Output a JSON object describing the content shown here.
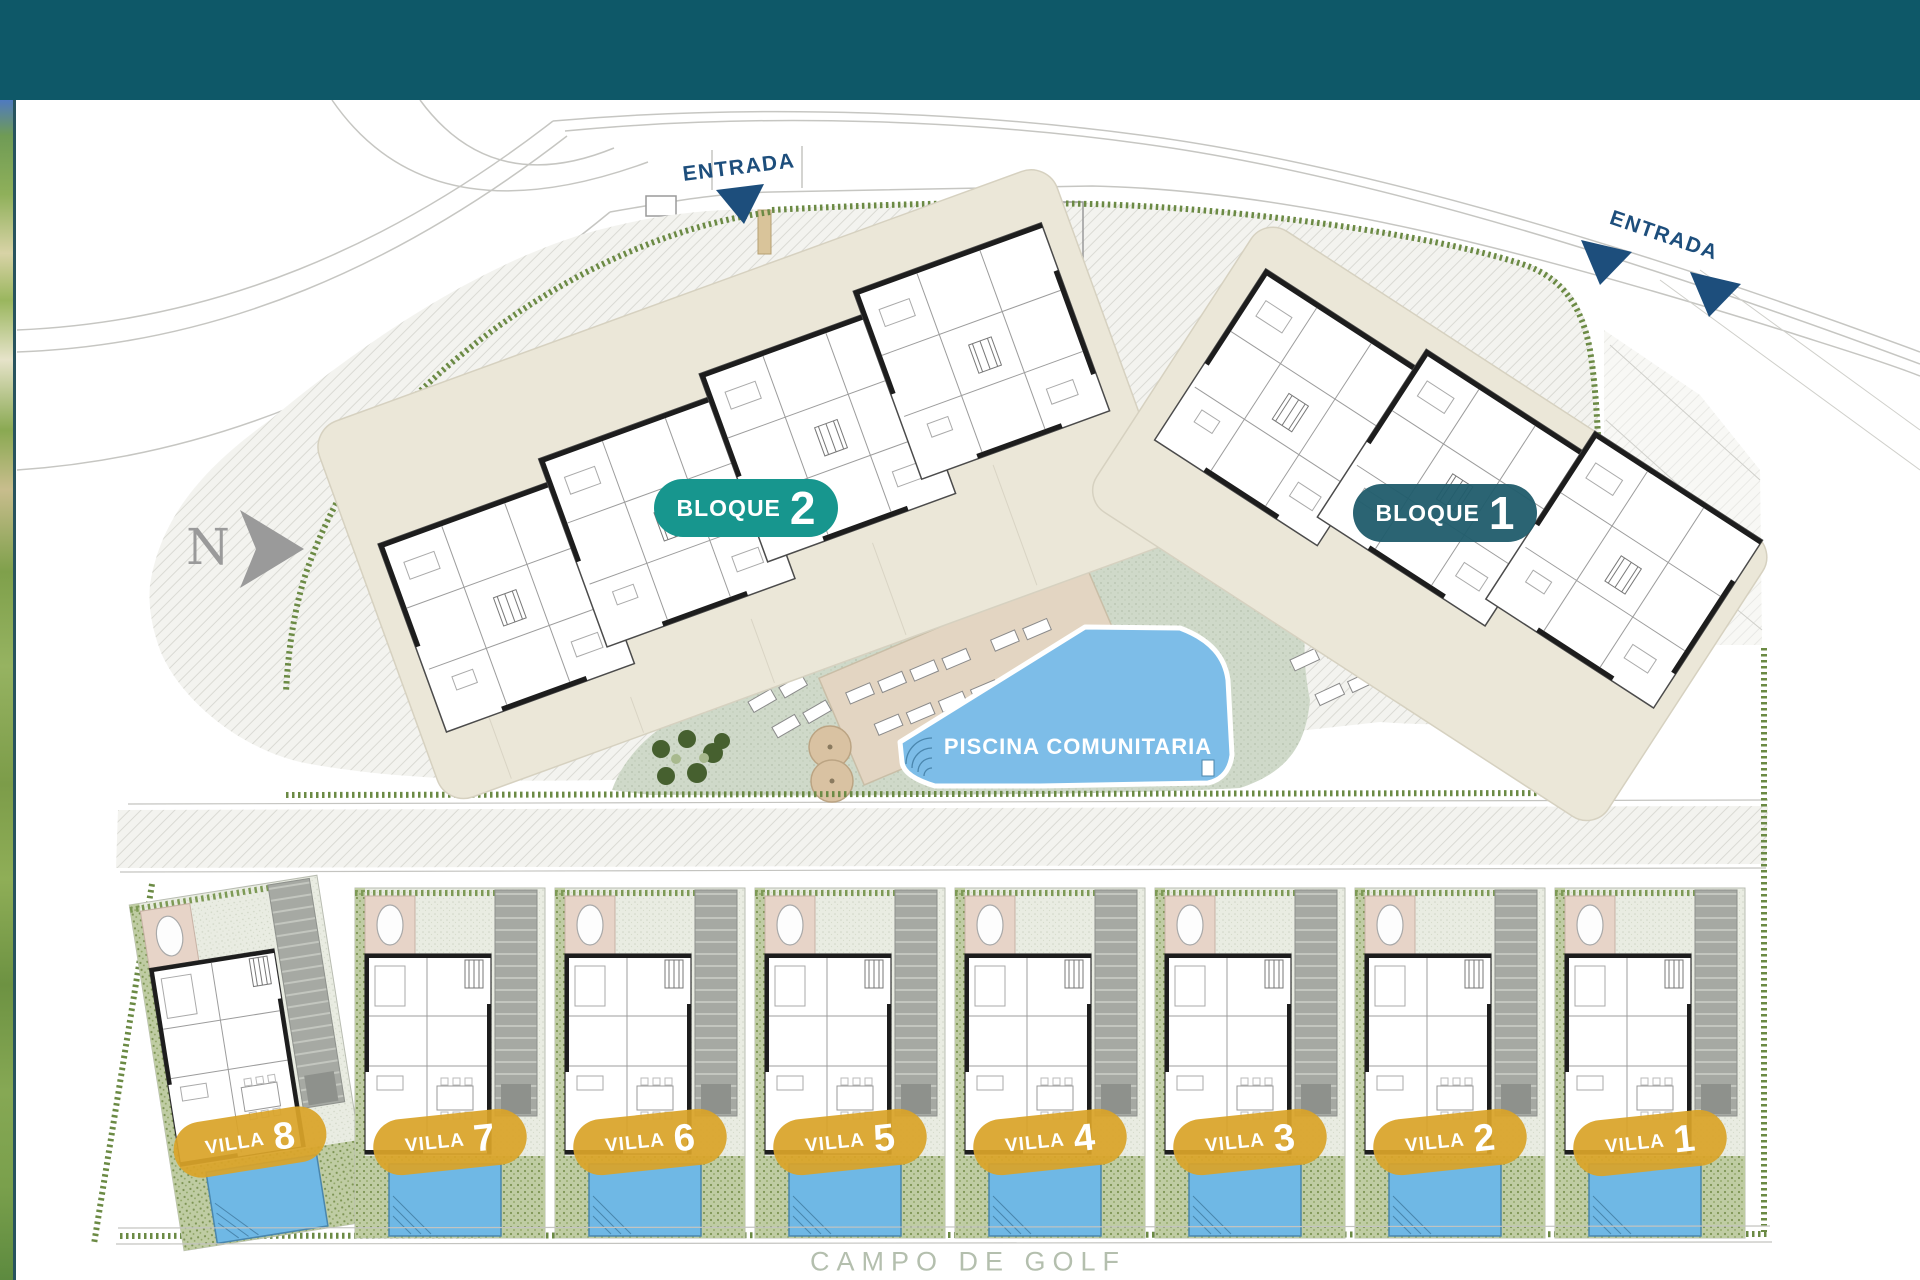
{
  "labels": {
    "entrada_top": "ENTRADA",
    "entrada_right": "ENTRADA",
    "piscina": "PISCINA COMUNITARIA",
    "campo": "CAMPO DE GOLF",
    "north": "N"
  },
  "blocks": [
    {
      "word": "BLOQUE",
      "num": "2"
    },
    {
      "word": "BLOQUE",
      "num": "1"
    }
  ],
  "villas": [
    {
      "word": "VILLA",
      "num": "8"
    },
    {
      "word": "VILLA",
      "num": "7"
    },
    {
      "word": "VILLA",
      "num": "6"
    },
    {
      "word": "VILLA",
      "num": "5"
    },
    {
      "word": "VILLA",
      "num": "4"
    },
    {
      "word": "VILLA",
      "num": "3"
    },
    {
      "word": "VILLA",
      "num": "2"
    },
    {
      "word": "VILLA",
      "num": "1"
    }
  ],
  "colors": {
    "header_teal": "#0E5868",
    "bloque2_teal": "#17968E",
    "bloque1_dark_teal": "#20606F",
    "villa_gold": "#D9A429",
    "entrada_blue": "#1D4E7C",
    "pool_blue": "#7DBDE8"
  }
}
